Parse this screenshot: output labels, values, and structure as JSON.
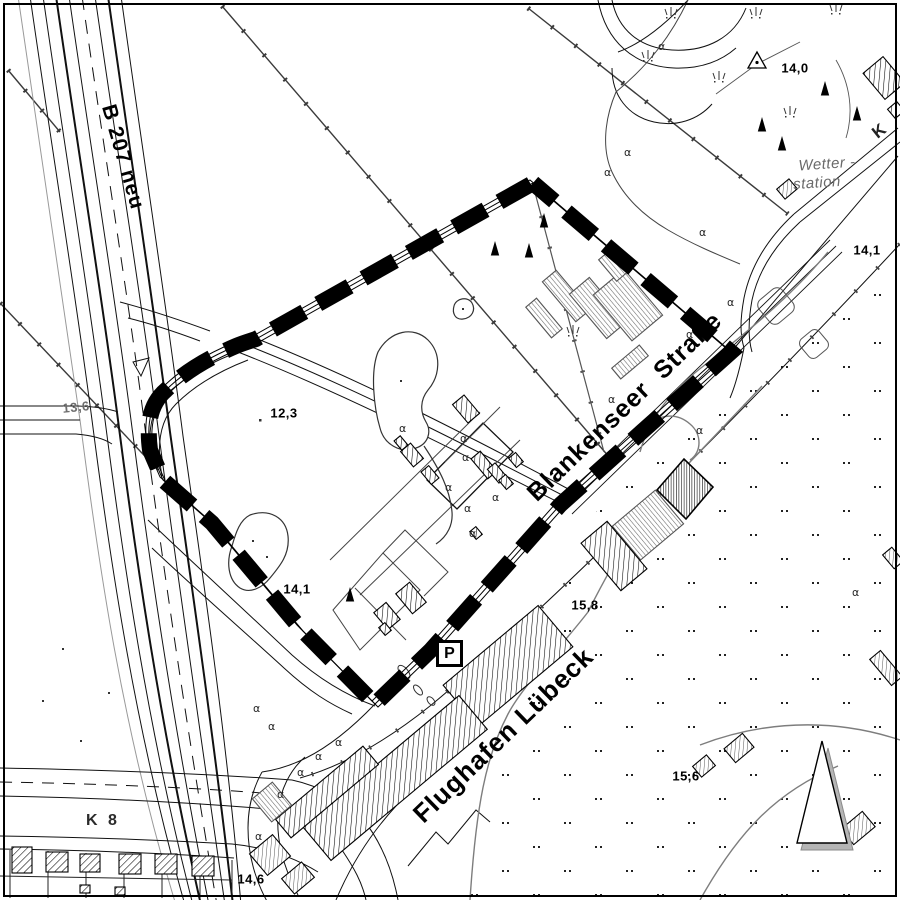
{
  "map": {
    "colors": {
      "paper": "#ffffff",
      "ink": "#000000",
      "muted_line": "#888888",
      "boundary": "#000000",
      "arrow_shadow": "#b5b5b5"
    },
    "roads": {
      "b207_label": "B 207 neu",
      "blankenseer_label": "Blankenseer  Straße",
      "k8_label": "K 8",
      "k_corner_label": "K"
    },
    "airport_label": "Flughafen Lübeck",
    "weather_station": {
      "line1": "Wetter -",
      "line2": "station"
    },
    "parking_symbol": "P",
    "elevations": {
      "ne": "14,0",
      "east": "14,1",
      "west": "13,6",
      "center_north": "12,3",
      "center": "14,1",
      "apron": "15,8",
      "southeast": "15,6",
      "south": "14,6"
    },
    "icons": {
      "north_arrow": "north-arrow-triangle",
      "trig_point": "triangulation-triangle-dot",
      "conifer": "filled-triangle-tree",
      "bush": "curl-symbol",
      "grass": "tuft-symbol",
      "parking": "boxed-P"
    }
  }
}
